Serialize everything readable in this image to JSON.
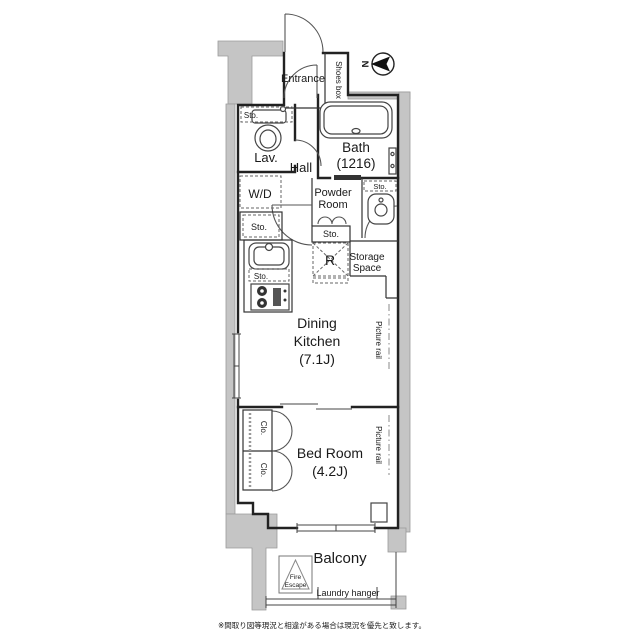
{
  "compass": {
    "north": "N"
  },
  "rooms": {
    "entrance": "Entrance",
    "shoes_box": "Shoes box",
    "hall": "Hall",
    "lavatory": "Lav.",
    "bath": {
      "line1": "Bath",
      "line2": "(1216)"
    },
    "washer_dryer": "W/D",
    "powder_room": {
      "line1": "Powder",
      "line2": "Room"
    },
    "refrigerator": "R",
    "storage_space": {
      "line1": "Storage",
      "line2": "Space"
    },
    "dining_kitchen": {
      "line1": "Dining",
      "line2": "Kitchen",
      "line3": "(7.1J)"
    },
    "bed_room": {
      "line1": "Bed Room",
      "line2": "(4.2J)"
    },
    "balcony": "Balcony"
  },
  "labels": {
    "storage_abbr": "Sto.",
    "closet_abbr": "Clo.",
    "picture_rail": "Picture rail",
    "fire_escape": {
      "line1": "Fire",
      "line2": "Escape"
    },
    "laundry_hanger": "Laundry hanger"
  },
  "footnote": "※間取り図等現況と相違がある場合は現況を優先と致します。",
  "colors": {
    "wall_line": "#222222",
    "exterior_gray": "#c5c5c5",
    "text": "#1a1a1a",
    "background": "#ffffff"
  }
}
